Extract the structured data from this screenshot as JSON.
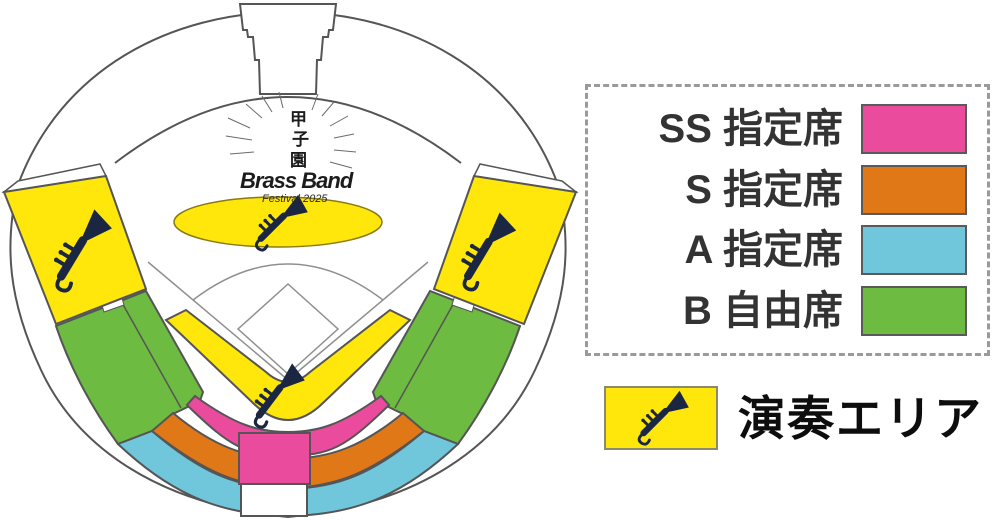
{
  "logo": {
    "kanji_1": "甲",
    "kanji_2": "子",
    "kanji_3": "園",
    "name": "Brass Band",
    "subtitle": "Festival 2025"
  },
  "legend": {
    "rows": [
      {
        "label": "SS 指定席",
        "color": "#ea4b9d",
        "category": "ss"
      },
      {
        "label": "S 指定席",
        "color": "#e07818",
        "category": "s"
      },
      {
        "label": "A 指定席",
        "color": "#70c6db",
        "category": "a"
      },
      {
        "label": "B 自由席",
        "color": "#6dbb40",
        "category": "b"
      }
    ],
    "performance": {
      "label": "演奏エリア",
      "color": "#ffe60b"
    }
  },
  "colors": {
    "ss": "#ea4b9d",
    "s": "#e07818",
    "a": "#70c6db",
    "b": "#6dbb40",
    "performance": "#ffe60b",
    "white_area": "#ffffff",
    "outline": "#555555",
    "field_line": "#8f8f8f",
    "trumpet": "#1b2742"
  },
  "map": {
    "regions": [
      {
        "name": "left-alps-stand",
        "category": "performance"
      },
      {
        "name": "right-alps-stand",
        "category": "performance"
      },
      {
        "name": "center-field-ellipse",
        "category": "performance"
      },
      {
        "name": "backstop-v-band",
        "category": "performance"
      },
      {
        "name": "ss-arc-band",
        "category": "ss"
      },
      {
        "name": "ss-center-column",
        "category": "ss"
      },
      {
        "name": "s-arc-band",
        "category": "s"
      },
      {
        "name": "a-arc-band",
        "category": "a"
      },
      {
        "name": "left-infield-stand",
        "category": "b"
      },
      {
        "name": "right-infield-stand",
        "category": "b"
      }
    ]
  }
}
